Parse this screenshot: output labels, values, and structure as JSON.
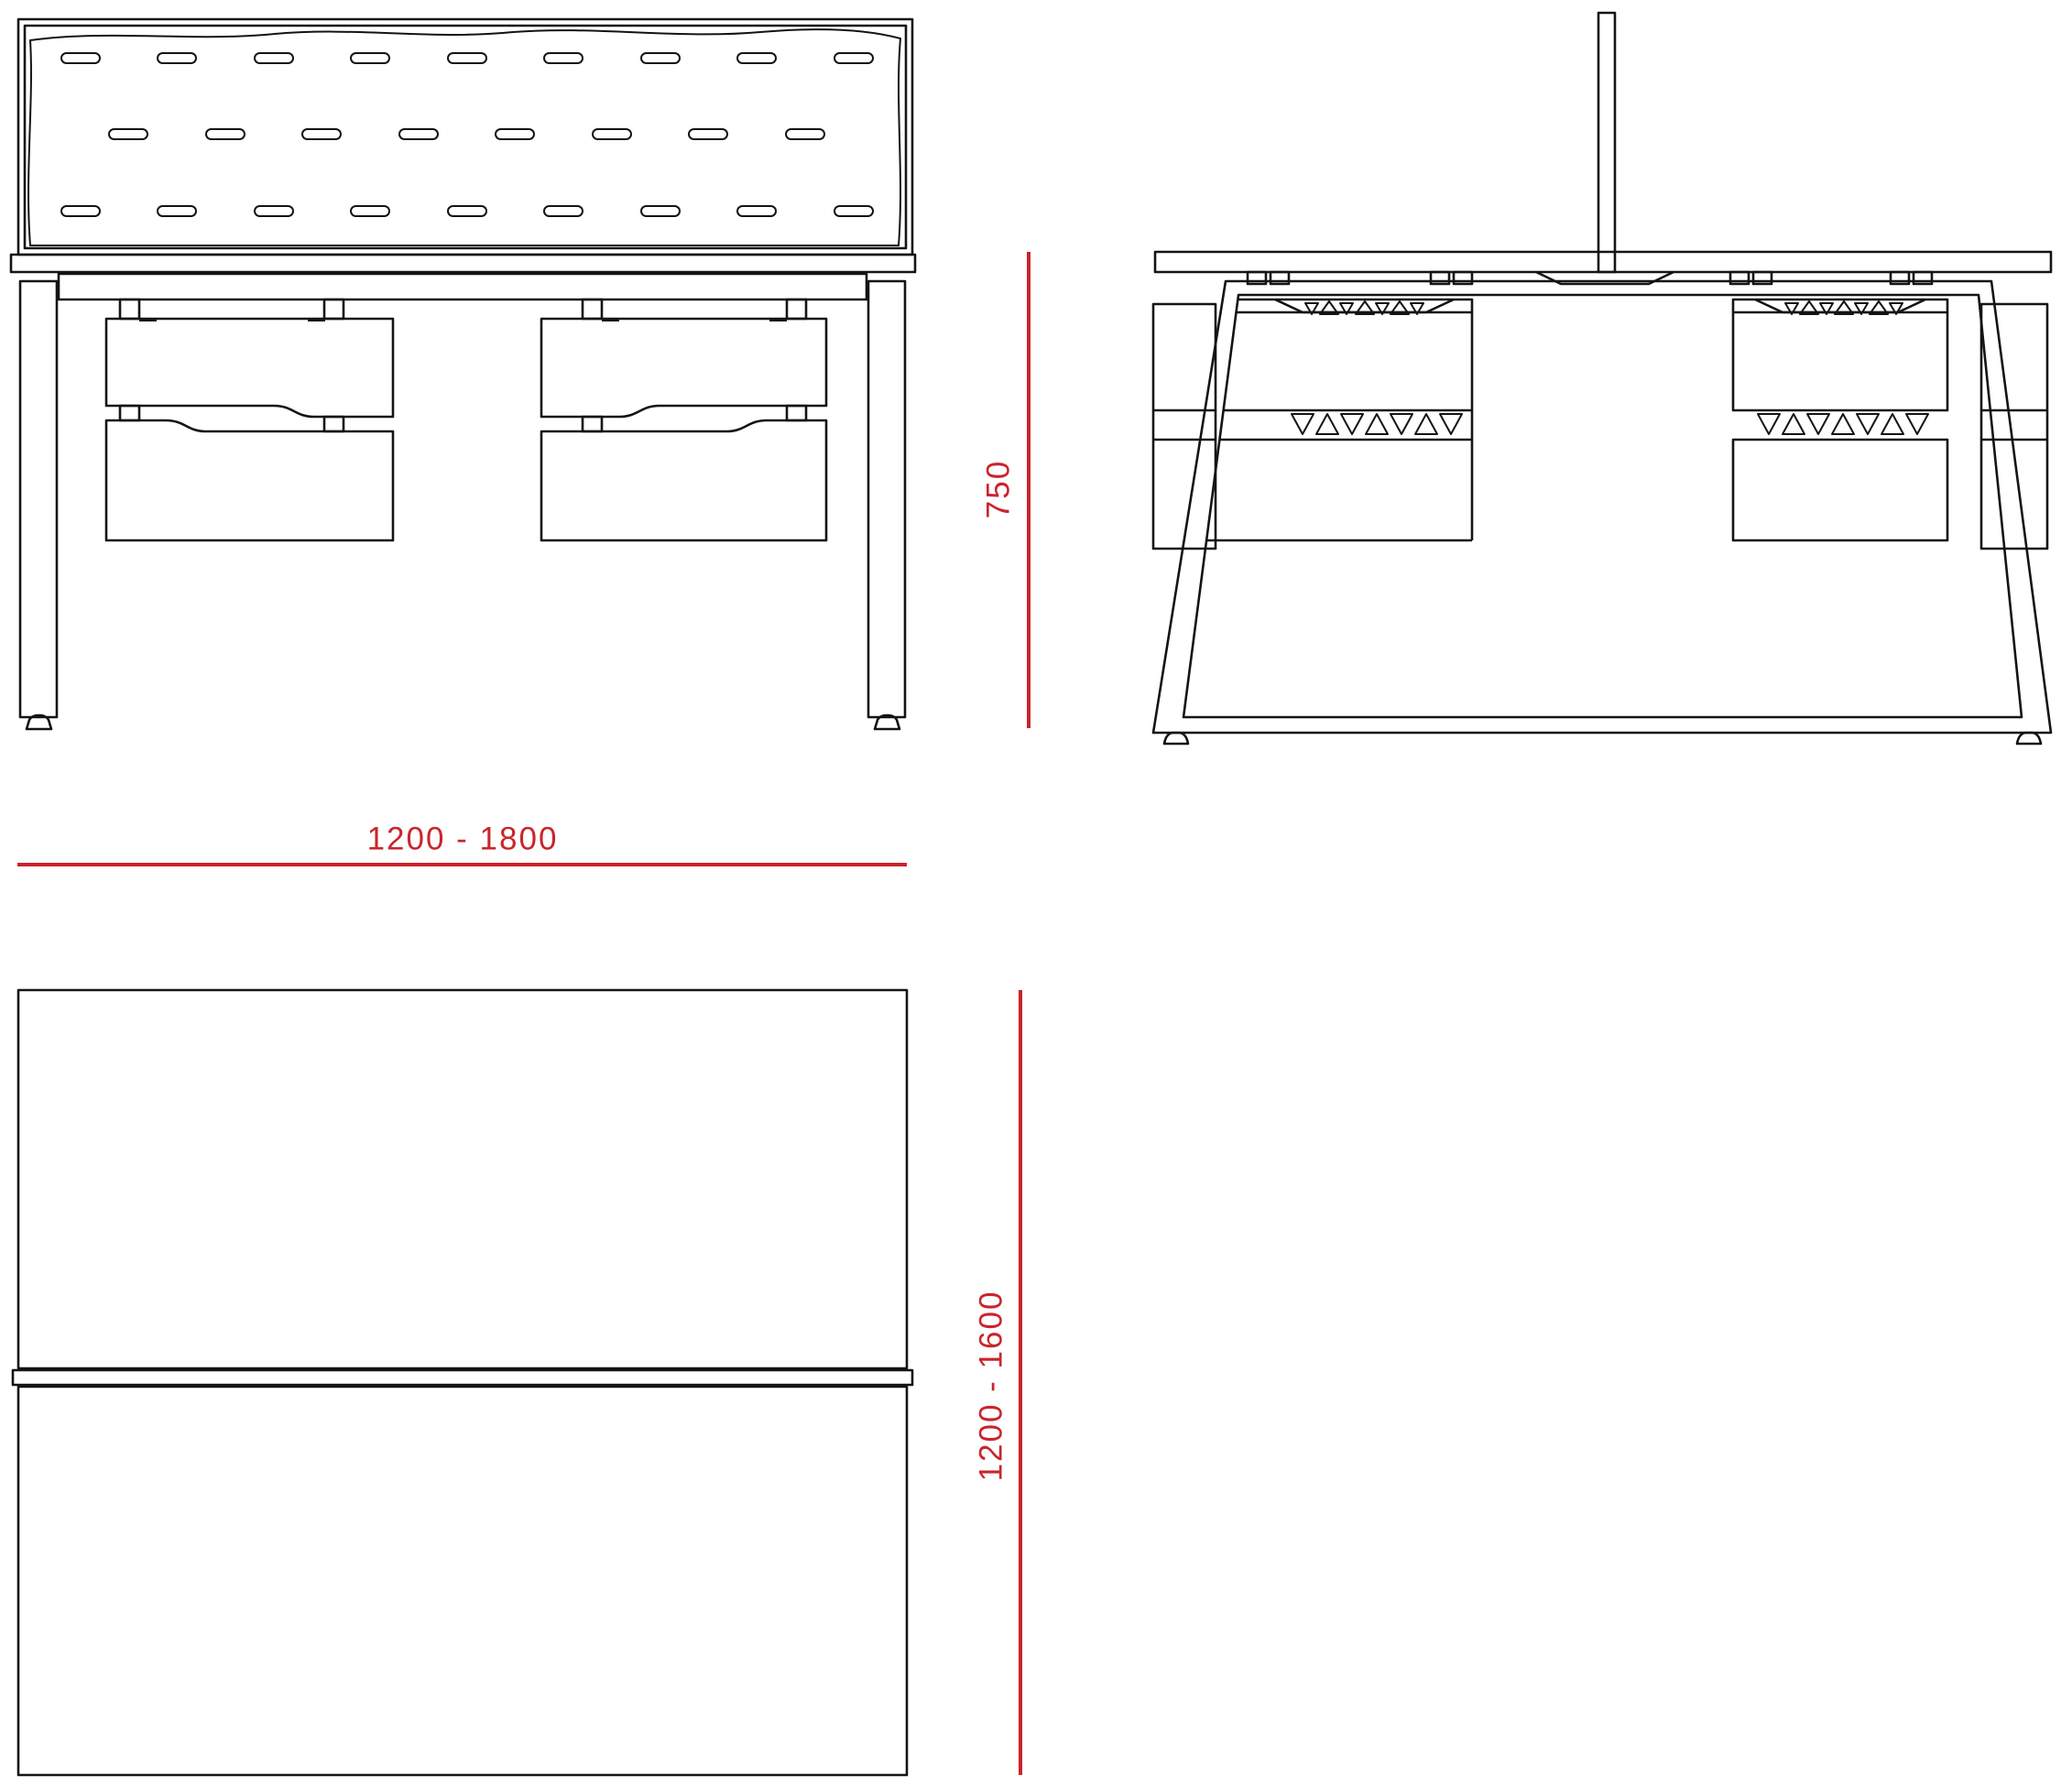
{
  "dimensions": {
    "width_label": "1200 - 1800",
    "height_label": "750",
    "depth_label": "1200 - 1600"
  },
  "colors": {
    "accent_red": "#c9252c",
    "ink": "#141414",
    "background": "#ffffff"
  }
}
